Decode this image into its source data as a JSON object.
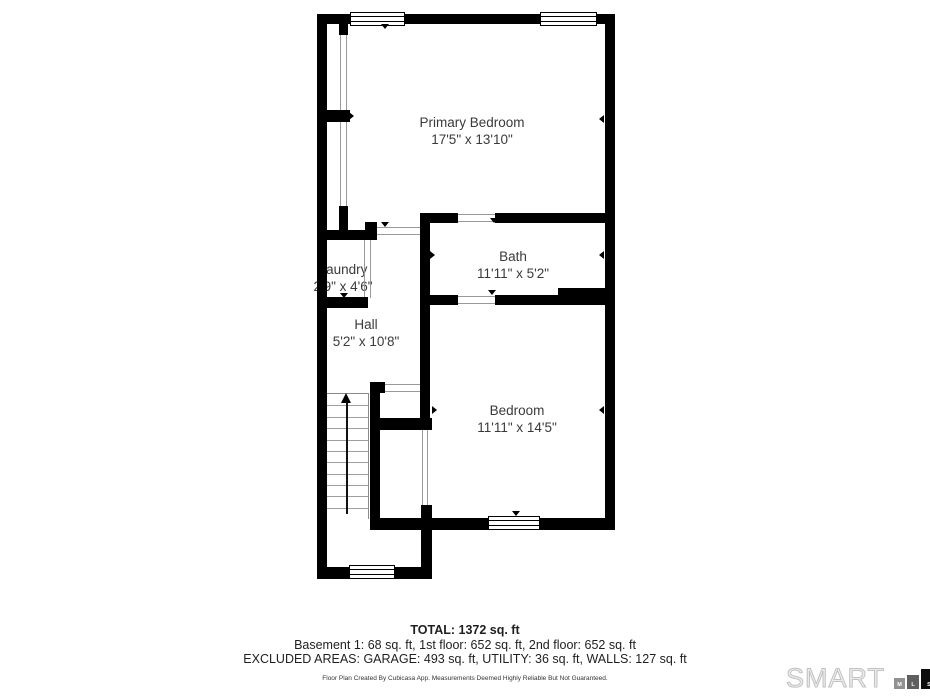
{
  "rooms": {
    "primary_bedroom": {
      "name": "Primary Bedroom",
      "dimensions": "17'5\" x 13'10\""
    },
    "bath": {
      "name": "Bath",
      "dimensions": "11'11\" x 5'2\""
    },
    "laundry": {
      "name": "Laundry",
      "dimensions": "2'9\" x 4'6\""
    },
    "hall": {
      "name": "Hall",
      "dimensions": "5'2\" x 10'8\""
    },
    "bedroom": {
      "name": "Bedroom",
      "dimensions": "11'11\" x 14'5\""
    }
  },
  "summary": {
    "total": "TOTAL: 1372 sq. ft",
    "floors": "Basement 1: 68 sq. ft, 1st floor: 652 sq. ft, 2nd floor: 652 sq. ft",
    "excluded": "EXCLUDED AREAS: GARAGE: 493 sq. ft, UTILITY: 36 sq. ft, WALLS: 127 sq. ft"
  },
  "disclaimer": "Floor Plan Created By Cubicasa App. Measurements Deemed Highly Reliable But Not Guaranteed.",
  "logo": {
    "brand": "SMART",
    "squares": [
      {
        "letter": "M"
      },
      {
        "letter": "L"
      },
      {
        "letter": "S"
      }
    ]
  },
  "colors": {
    "wall": "#000000",
    "room_text": "#3a3a3a",
    "footer_text": "#1f1f1f",
    "stair_line": "#9e9e9e",
    "opening_line": "#999999",
    "logo_outline": "#c2c2c2",
    "mls_squares": [
      "#919191",
      "#5f5f5f",
      "#0d0d0d"
    ]
  }
}
